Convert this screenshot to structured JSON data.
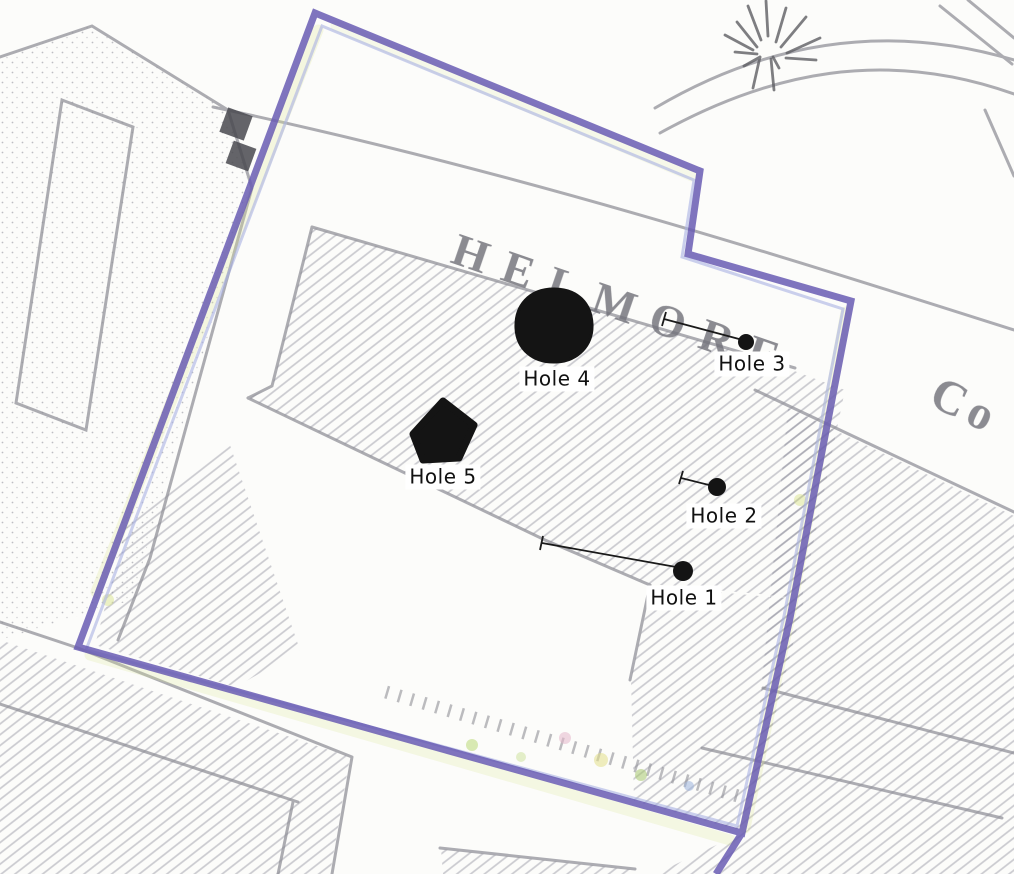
{
  "map": {
    "street_name": "HELMORE",
    "street_name_suffix": "Co",
    "boundary_color": "#695cb3",
    "marker_color": "#141414",
    "holes": [
      {
        "label": "Hole 1",
        "marker_type": "dot-with-leader-line"
      },
      {
        "label": "Hole 2",
        "marker_type": "dot-with-leader-line"
      },
      {
        "label": "Hole 3",
        "marker_type": "dot-with-leader-line"
      },
      {
        "label": "Hole 4",
        "marker_type": "filled-blob"
      },
      {
        "label": "Hole 5",
        "marker_type": "filled-diamond"
      }
    ]
  }
}
